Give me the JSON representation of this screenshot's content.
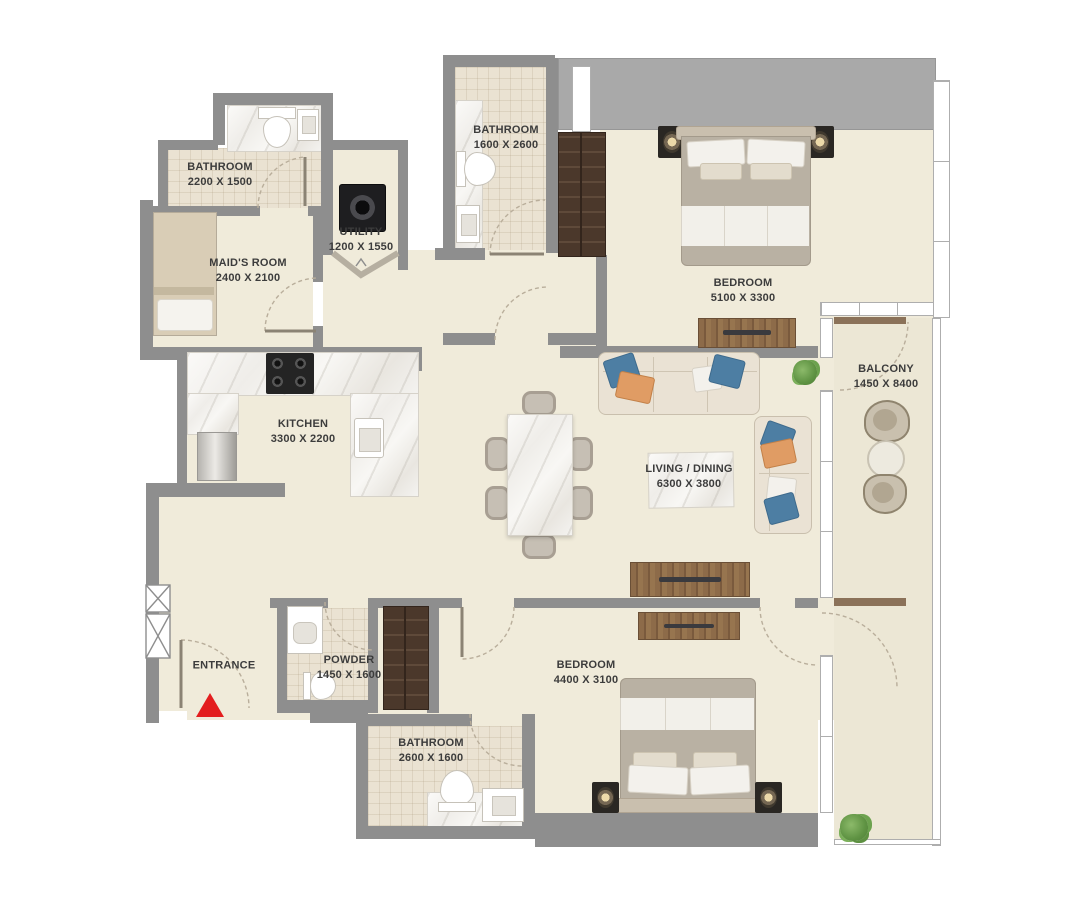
{
  "title": "Apartment Floor Plan",
  "rooms": [
    {
      "id": "bathroom-tl",
      "name": "BATHROOM",
      "dims": "2200 X 1500"
    },
    {
      "id": "maids-room",
      "name": "MAID'S ROOM",
      "dims": "2400 X 2100"
    },
    {
      "id": "utility",
      "name": "UTILITY",
      "dims": "1200 X 1550"
    },
    {
      "id": "bathroom-top",
      "name": "BATHROOM",
      "dims": "1600 X 2600"
    },
    {
      "id": "bedroom-master",
      "name": "BEDROOM",
      "dims": "5100 X 3300"
    },
    {
      "id": "balcony",
      "name": "BALCONY",
      "dims": "1450 X 8400"
    },
    {
      "id": "kitchen",
      "name": "KITCHEN",
      "dims": "3300 X 2200"
    },
    {
      "id": "living-dining",
      "name": "LIVING / DINING",
      "dims": "6300 X 3800"
    },
    {
      "id": "entrance",
      "name": "ENTRANCE",
      "dims": ""
    },
    {
      "id": "powder",
      "name": "POWDER",
      "dims": "1450 X 1600"
    },
    {
      "id": "bathroom-bottom",
      "name": "BATHROOM",
      "dims": "2600 X 1600"
    },
    {
      "id": "bedroom-second",
      "name": "BEDROOM",
      "dims": "4400 X 3100"
    }
  ],
  "markers": {
    "entrance_arrow": "red-triangle-pointing-up"
  },
  "colors": {
    "wall": "#8e8e8e",
    "gray_block": "#a9a9a9",
    "floor": "#f0ebda",
    "balcony_floor": "#ece7d5",
    "tile": "#eae2d2",
    "accent_red": "#e31e1e",
    "pillow_blue": "#4d7ea3",
    "pillow_orange": "#e09c64",
    "partition_brown": "#8b7259",
    "plant_green": "#6da757",
    "wood": "#8a6848",
    "dark_wood": "#4b382b",
    "text": "#3c3c3c"
  }
}
